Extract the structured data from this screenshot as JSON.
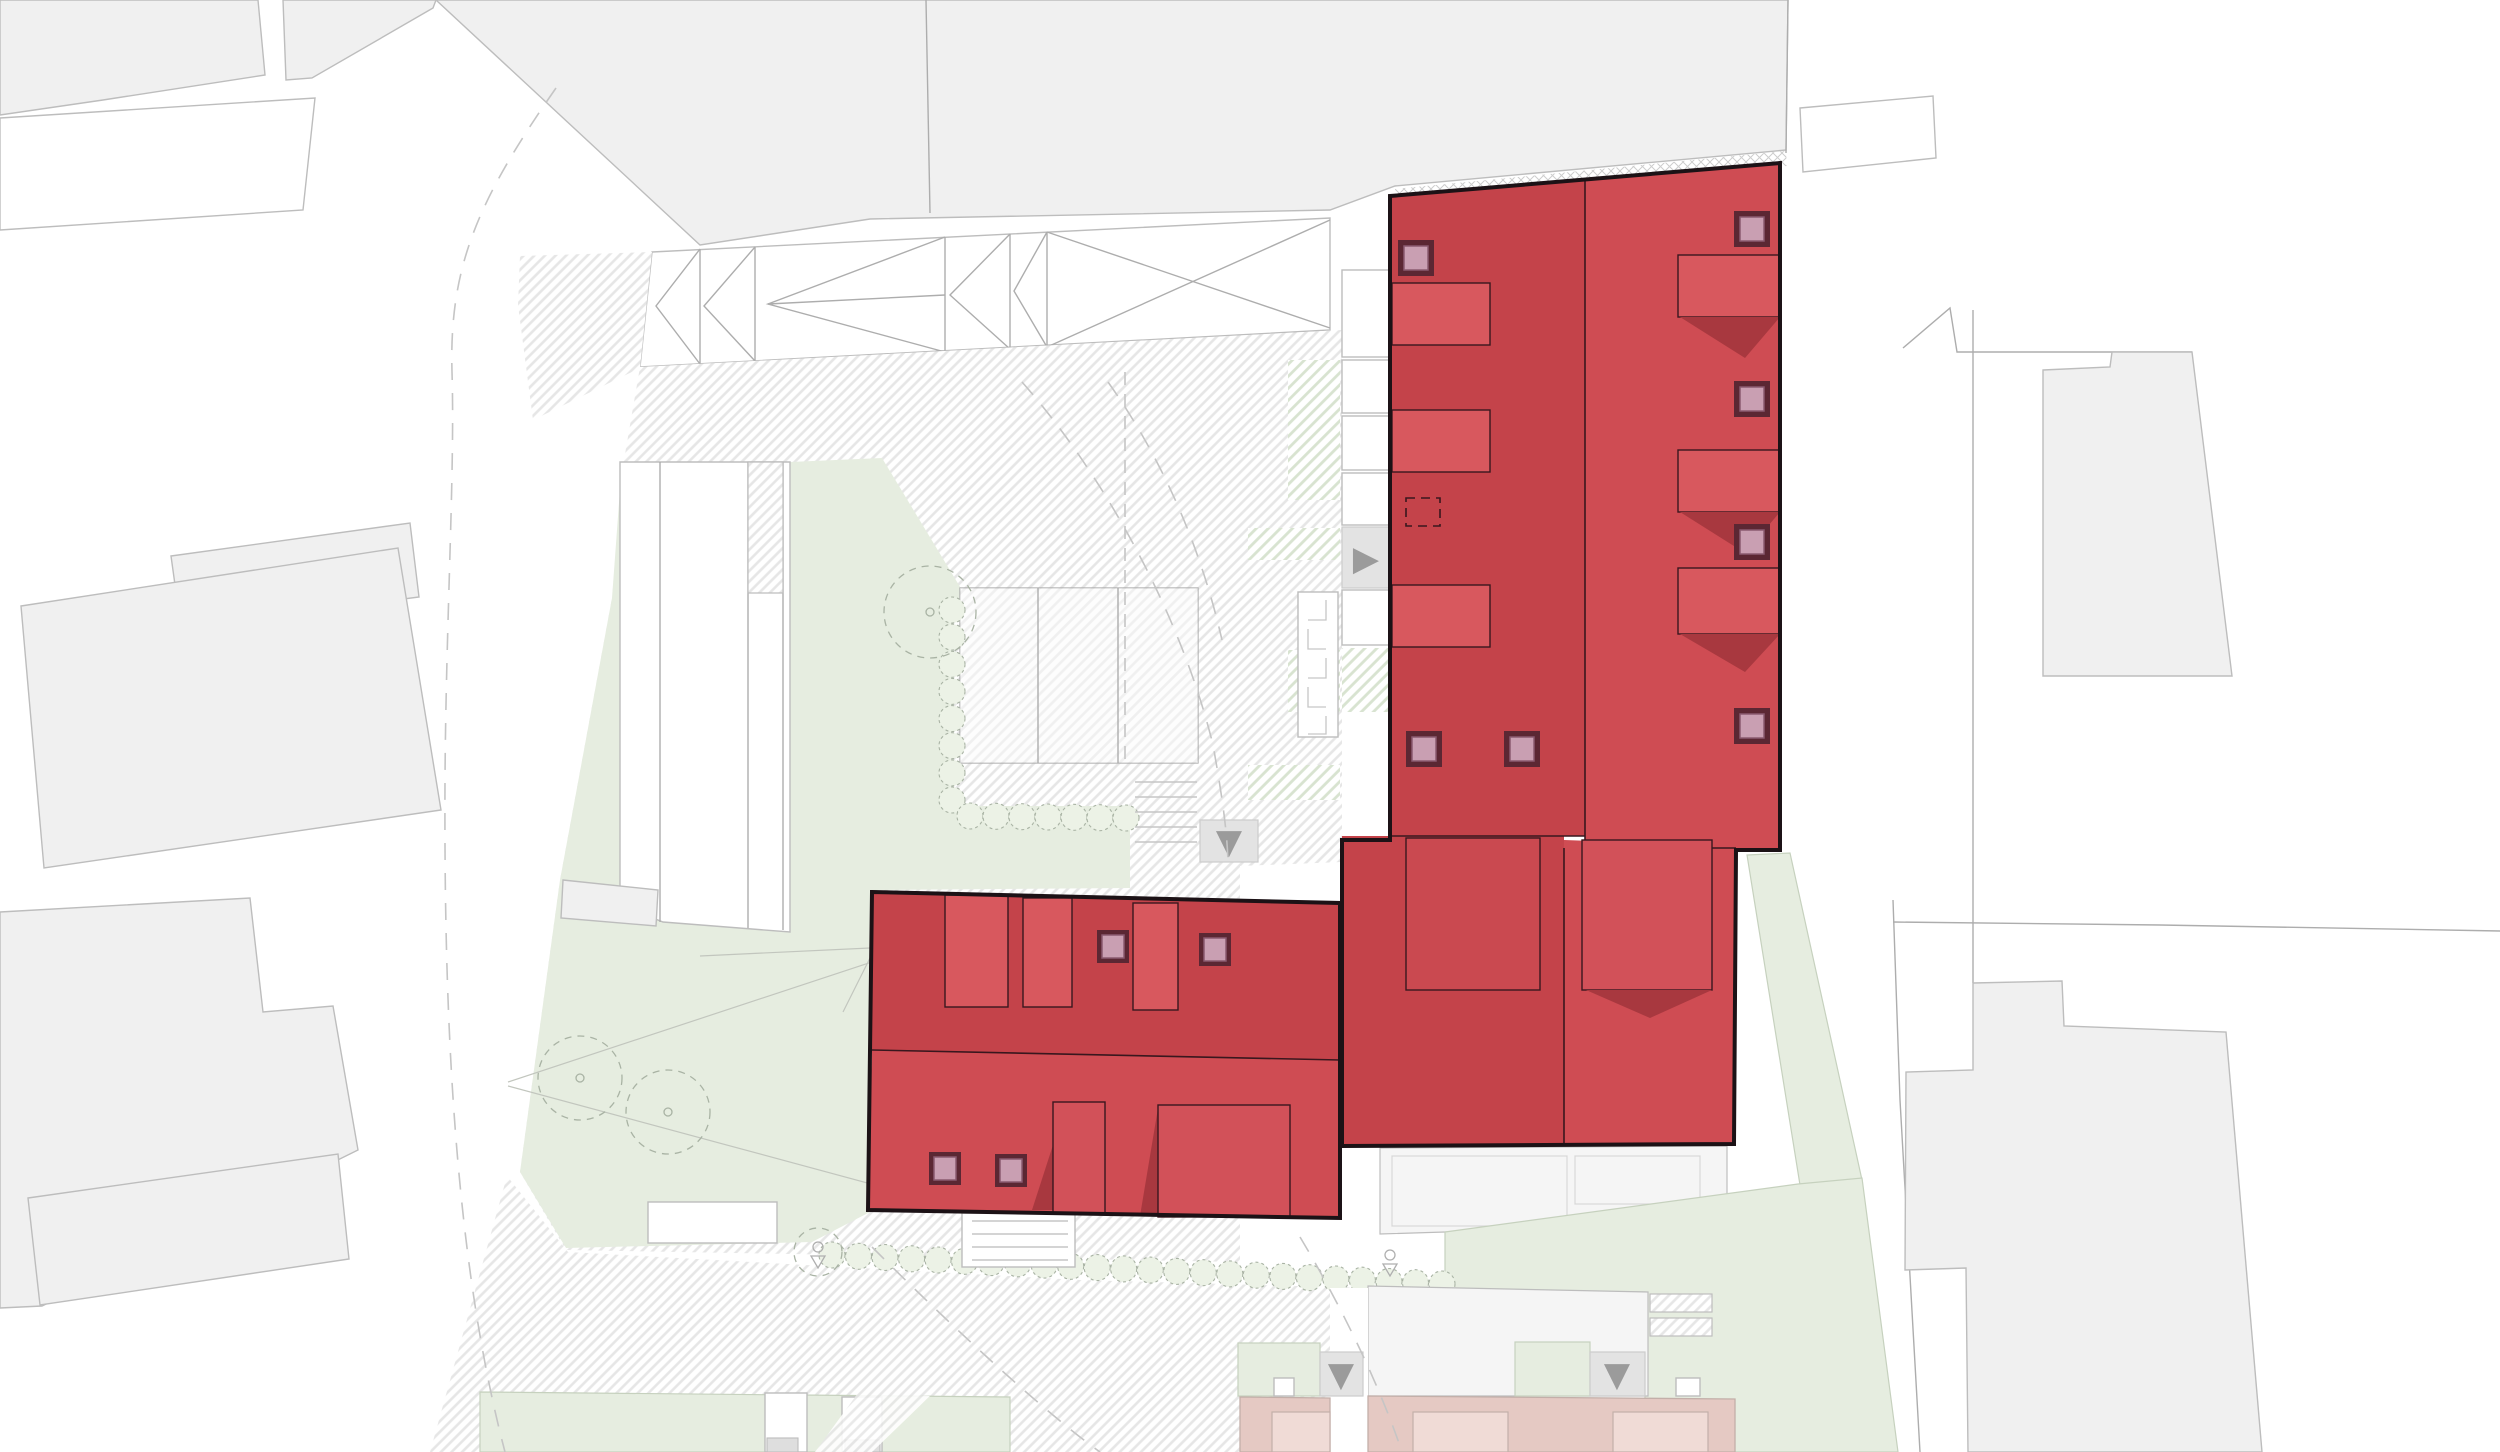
{
  "meta": {
    "kind": "architectural-site-plan",
    "view": "roof plan with highlighted project buildings",
    "visible_text": ""
  },
  "palette": {
    "background": "#FFFFFF",
    "parcel_fill": "#F0F0F0",
    "parcel_stroke": "#BDBDBD",
    "line": "#ADADAD",
    "faint_line": "#D8D8D8",
    "hatch_line": "#E6E6E6",
    "crosshatch_line": "#CDCDCD",
    "greenhatch_line": "#D8E3D0",
    "lawn": "#E6EDE0",
    "lawn_line": "#C6D1BE",
    "hedge_fill": "#ECF2E6",
    "hedge_stroke": "#A9B3A4",
    "red_dark": "#C4434A",
    "red_light": "#CF4C53",
    "red_dormer": "#D8585E",
    "red_inset_dark": "#CA4950",
    "red_inset_light": "#D25159",
    "red_shadow": "#A8383F",
    "building_outline": "#1C1216",
    "detail_outline": "#39171E",
    "skylight_frame": "#5B2733",
    "skylight_glass": "#C99FB2",
    "skylight_edge": "#8A5A70",
    "salmon_fill": "#E5C9C3",
    "salmon_inset": "#F0DBD6",
    "salmon_stroke": "#C3AFA9",
    "ramp_fill": "#E3E3E3",
    "ramp_stroke": "#CCCCCC",
    "arrow_color": "#9B9B9B",
    "stair_line": "#C6C6C6",
    "road_dash": "#C5C5C5",
    "pavement": "#F5F5F5"
  },
  "icons": {
    "arrow_right_glyph": "▶",
    "arrow_down_glyph": "▼"
  },
  "site": {
    "highlighted_buildings": 2,
    "context_buildings": 9,
    "skylights": 11,
    "roof_dormers": 11,
    "trees": 3,
    "hedge_rows": 3,
    "parking_bays": 3,
    "stair_flights": 2,
    "ramp_markers": 4
  }
}
